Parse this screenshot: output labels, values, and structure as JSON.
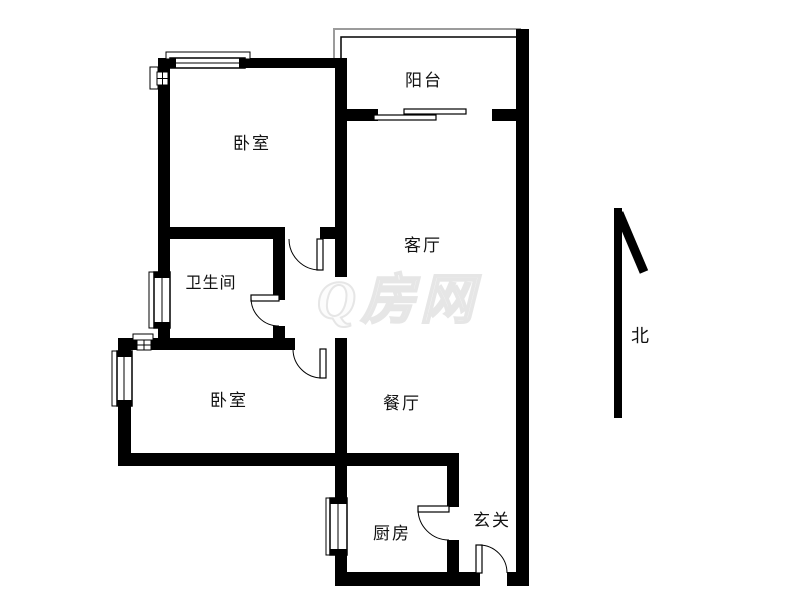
{
  "page": {
    "background": "#ffffff"
  },
  "floorplan": {
    "rooms": [
      {
        "id": "balcony",
        "label": "阳台"
      },
      {
        "id": "bedroom-top",
        "label": "卧室"
      },
      {
        "id": "living-room",
        "label": "客厅"
      },
      {
        "id": "bathroom",
        "label": "卫生间"
      },
      {
        "id": "bedroom-bottom",
        "label": "卧室"
      },
      {
        "id": "dining-room",
        "label": "餐厅"
      },
      {
        "id": "kitchen",
        "label": "厨房"
      },
      {
        "id": "entryway",
        "label": "玄关"
      }
    ],
    "compass": {
      "label": "北"
    },
    "watermark": {
      "text": "Q房网"
    },
    "colors": {
      "wall": "#000000",
      "railing": "#9b9b9b",
      "watermark_stroke": "#e6e6e6",
      "label_text": "#111111"
    }
  }
}
